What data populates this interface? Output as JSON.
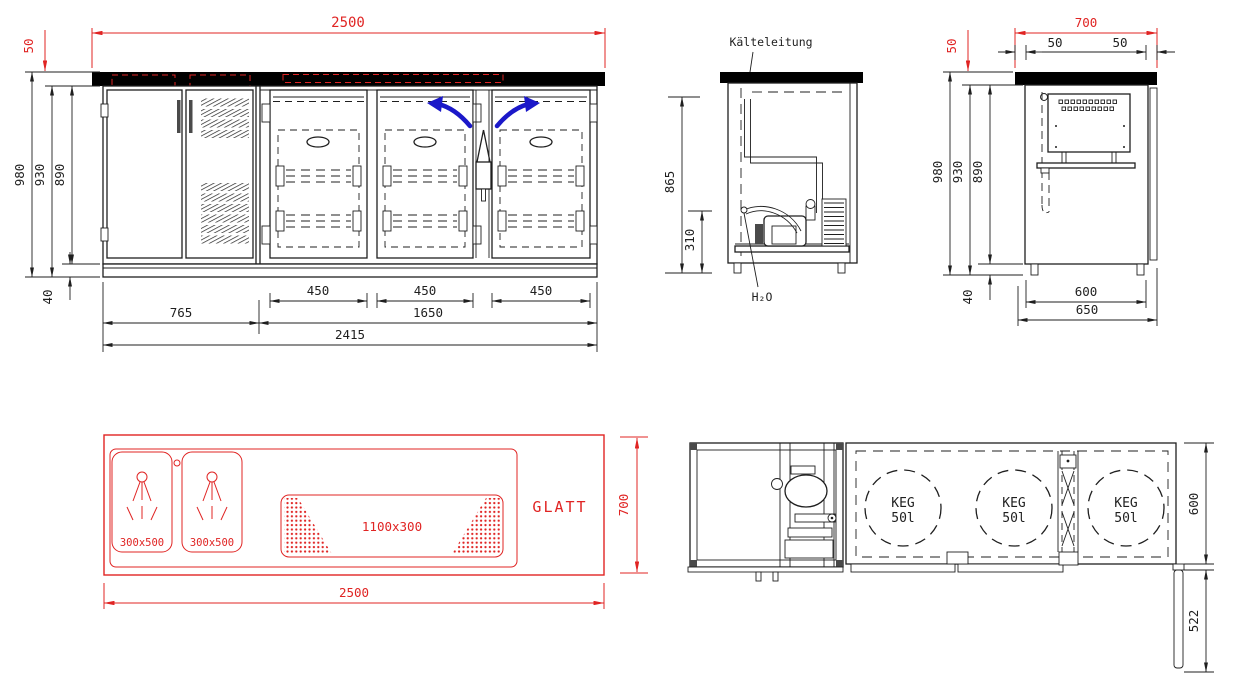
{
  "colors": {
    "red": "#e02423",
    "blue": "#1b18c9",
    "line": "#1f1f1f",
    "handle": "#4a4a4a"
  },
  "front": {
    "d2500": "2500",
    "d50": "50",
    "d980": "980",
    "d930": "930",
    "d890": "890",
    "d40": "40",
    "d765": "765",
    "d450_1": "450",
    "d450_2": "450",
    "d450_3": "450",
    "d1650": "1650",
    "d2415": "2415"
  },
  "section": {
    "kaelteleitung": "Kälteleitung",
    "h2o": "H₂O",
    "d865": "865",
    "d310": "310"
  },
  "side": {
    "d700": "700",
    "d50red": "50",
    "d50a": "50",
    "d50b": "50",
    "d980": "980",
    "d930": "930",
    "d890": "890",
    "d40": "40",
    "d600": "600",
    "d650": "650"
  },
  "counter": {
    "sink1": "300x500",
    "sink2": "300x500",
    "drainer": "1100x300",
    "glatt": "GLATT",
    "d700": "700",
    "d2500": "2500"
  },
  "plan": {
    "kegs": [
      {
        "label": "KEG",
        "vol": "50l"
      },
      {
        "label": "KEG",
        "vol": "50l"
      },
      {
        "label": "KEG",
        "vol": "50l"
      }
    ],
    "d600": "600",
    "d522": "522"
  }
}
